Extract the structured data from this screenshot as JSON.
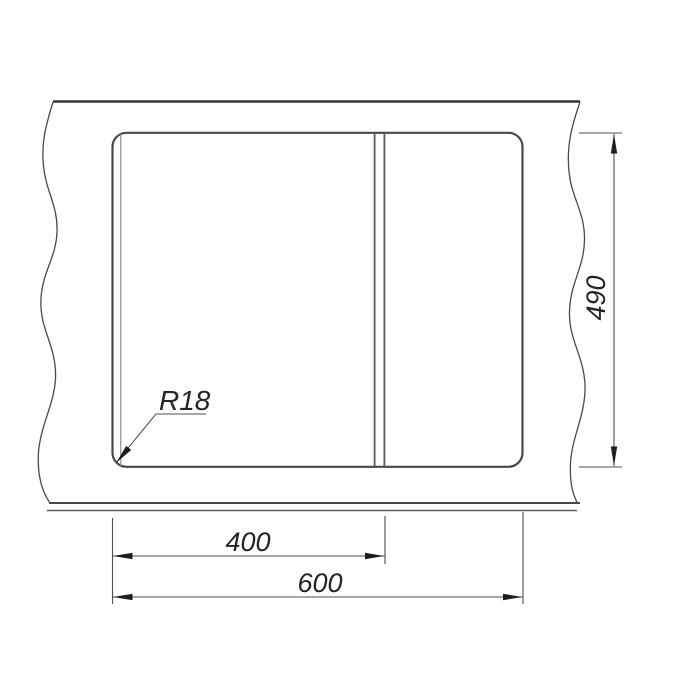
{
  "drawing": {
    "type": "technical-dimension-drawing",
    "line_color": "#4a4a4a",
    "text_color": "#242424",
    "background": "#ffffff",
    "dimensions": {
      "corner_radius": "R18",
      "inner_width": "400",
      "overall_width": "600",
      "overall_depth": "490"
    }
  }
}
